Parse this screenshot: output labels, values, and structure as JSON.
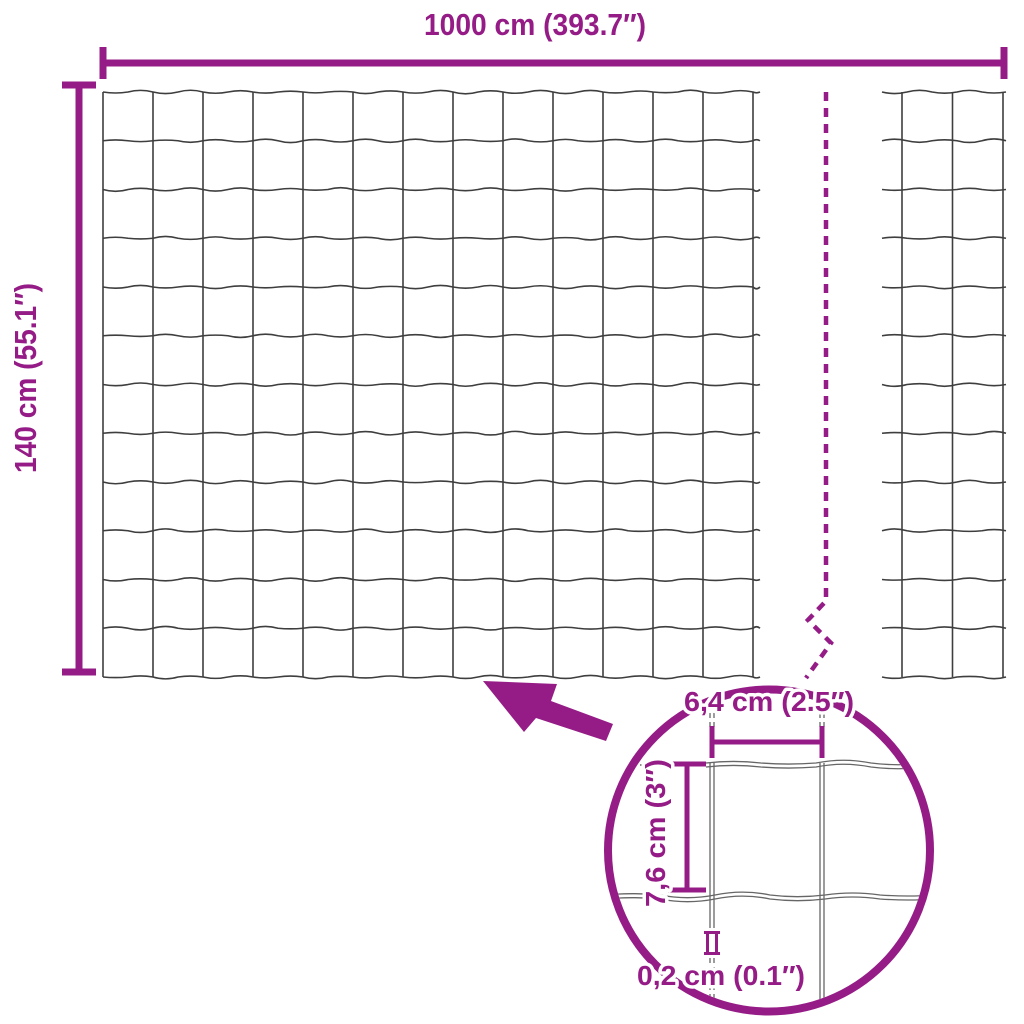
{
  "diagram": {
    "subject": "garden wire mesh fence dimensions",
    "view": "front view with zoom detail circle"
  },
  "labels": {
    "total_width": "1000 cm (393.7″)",
    "total_height": "140 cm (55.1″)",
    "mesh_cell_width": "6,4 cm (2.5″)",
    "mesh_cell_height": "7,6 cm (3″)",
    "wire_thickness": "0,2 cm (0.1″)"
  },
  "colors": {
    "accent": "#951c86",
    "wire": "#3e3e3e",
    "wire_detail": "#666666",
    "background": "#ffffff"
  },
  "mesh": {
    "main_panel": {
      "vertical_wires": 14,
      "horizontal_wires": 13
    },
    "right_strip": {
      "vertical_wires": 3,
      "horizontal_wires": 13
    }
  }
}
